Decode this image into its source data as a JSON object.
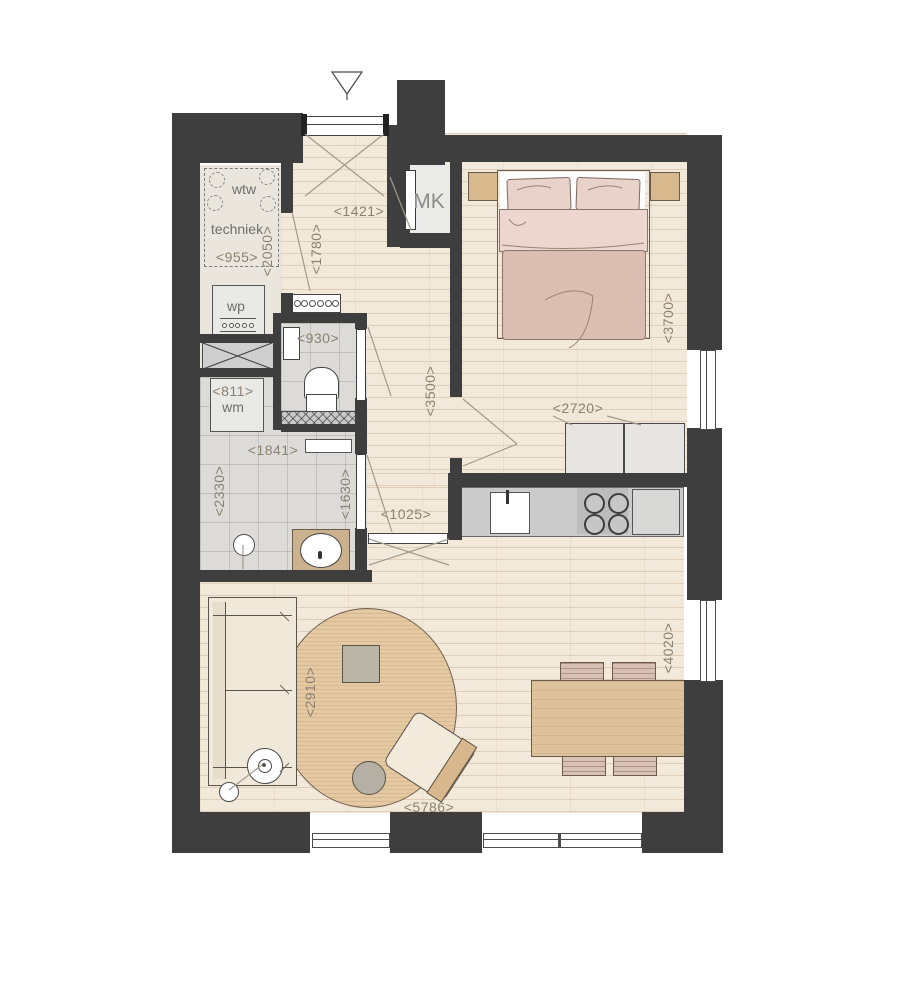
{
  "plan": {
    "title": "apartment-floor-plan",
    "room_labels": {
      "wtw": "wtw",
      "techniek": "techniek",
      "wp": "wp",
      "wm": "wm",
      "mk": "MK"
    },
    "dimensions": {
      "hall_width": "<1421>",
      "hall_depth": "<1780>",
      "techniek_depth": "<2050>",
      "techniek_width": "<955>",
      "toilet_width": "<930>",
      "wm_width": "<811>",
      "bath_width": "<1841>",
      "hall_length": "<3500>",
      "bedroom_depth": "<3700>",
      "wardrobe_width": "<2720>",
      "opening_width": "<1025>",
      "bath_depth": "<2330>",
      "bath_inner": "<1630>",
      "rug_diameter": "<2910>",
      "dining_depth": "<4020>",
      "living_width": "<5786>"
    },
    "colors": {
      "wall": "#3e3e3e",
      "wood_floor": "#f3e9da",
      "tile_floor": "#dcdbd7",
      "bed_duvet": "#dcbdb2",
      "rug": "#e5c9a3",
      "furniture_wood": "#dec29b"
    }
  }
}
